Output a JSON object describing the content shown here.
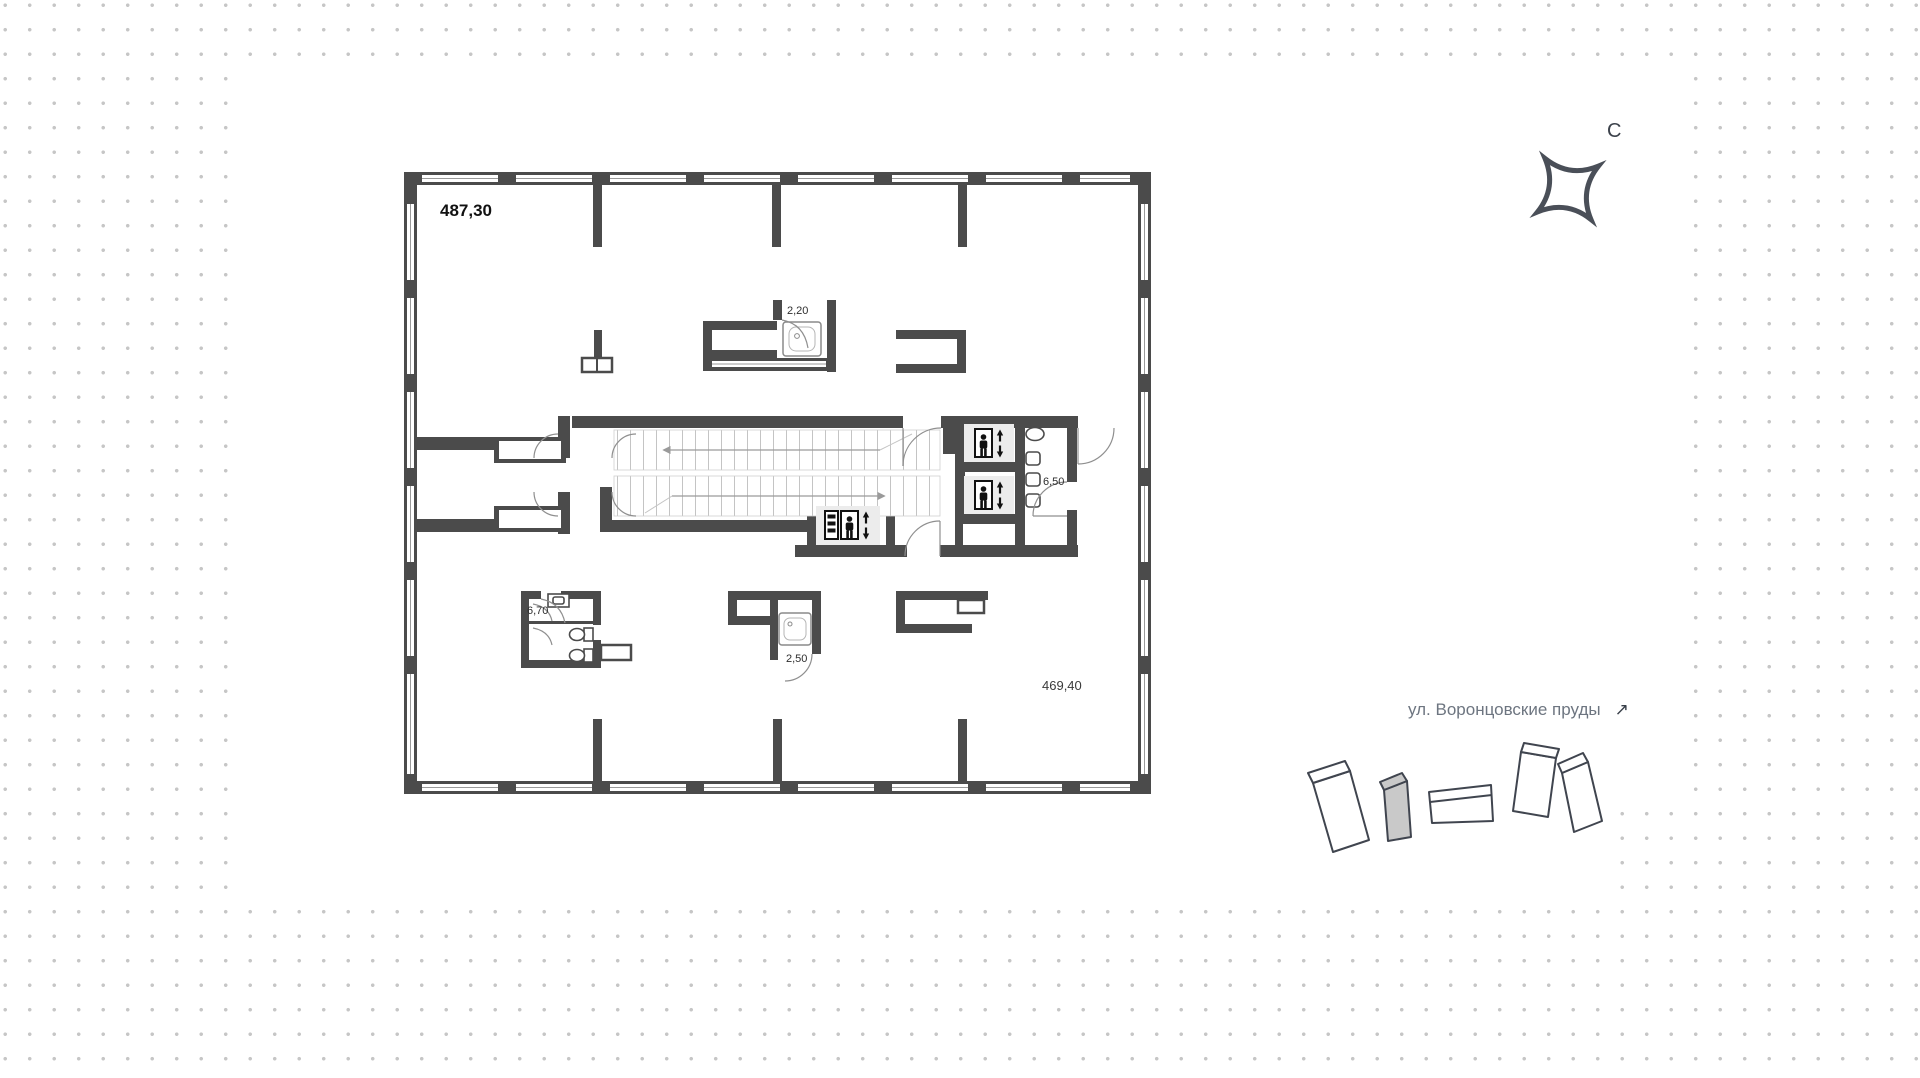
{
  "floor_plan": {
    "total_area": "487,30",
    "open_area": "469,40",
    "rooms": {
      "shower_top_area": "2,20",
      "wc_right_area": "6,50",
      "wc_left_area": "6,70",
      "shower_bottom_area": "2,50"
    }
  },
  "compass": {
    "north_label": "С"
  },
  "location": {
    "street_label": "ул. Воронцовские пруды",
    "arrow_icon": "↗"
  },
  "site_map": {
    "buildings_count": 5,
    "highlighted_building_index": 2
  }
}
